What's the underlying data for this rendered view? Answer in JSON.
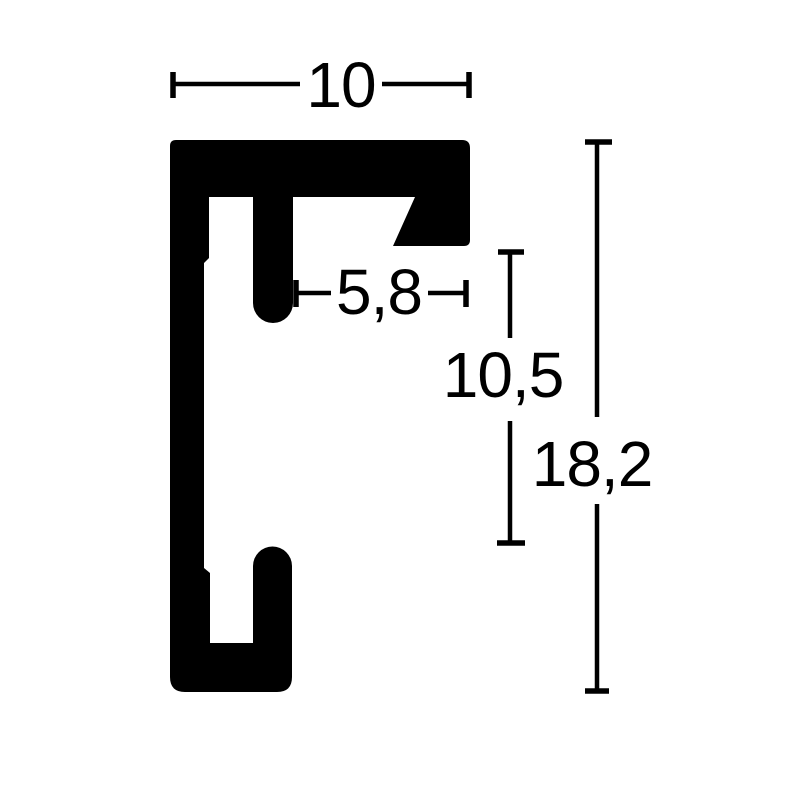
{
  "page": {
    "background": "#ffffff"
  },
  "diagram": {
    "name": "aluminium-frame-profile-cross-section",
    "ink": "#000000",
    "labels": {
      "width_top": "10",
      "width_inner": "5,8",
      "height_inner": "10,5",
      "height_total": "18,2"
    }
  }
}
